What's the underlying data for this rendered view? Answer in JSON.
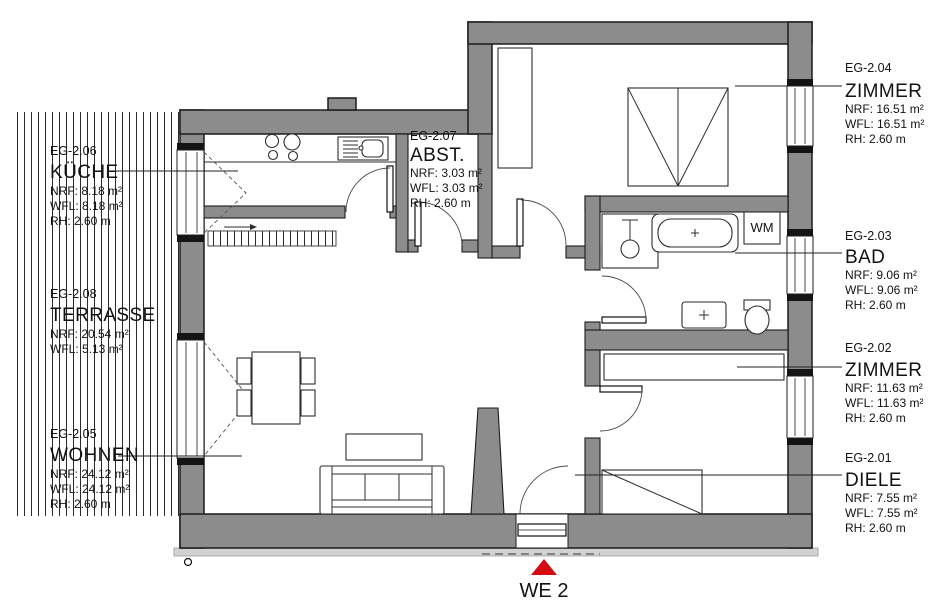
{
  "plan": {
    "unit": "WE 2",
    "labels": {
      "wm": "WM"
    },
    "rooms": [
      {
        "key": "kueche",
        "code": "EG-2.06",
        "name": "KÜCHE",
        "nrf": "NRF: 8.18 m²",
        "wfl": "WFL: 8.18 m²",
        "rh": "RH: 2.60 m"
      },
      {
        "key": "terrasse",
        "code": "EG-2.08",
        "name": "TERRASSE",
        "nrf": "NRF: 20.54 m²",
        "wfl": "WFL: 5.13 m²",
        "rh": ""
      },
      {
        "key": "wohnen",
        "code": "EG-2.05",
        "name": "WOHNEN",
        "nrf": "NRF: 24.12 m²",
        "wfl": "WFL: 24.12 m²",
        "rh": "RH: 2.60 m"
      },
      {
        "key": "abstellraum",
        "code": "EG-2.07",
        "name": "ABST.",
        "nrf": "NRF: 3.03 m²",
        "wfl": "WFL: 3.03 m²",
        "rh": "RH: 2.60 m"
      },
      {
        "key": "zimmer-204",
        "code": "EG-2.04",
        "name": "ZIMMER",
        "nrf": "NRF: 16.51 m²",
        "wfl": "WFL: 16.51 m²",
        "rh": "RH: 2.60 m"
      },
      {
        "key": "bad",
        "code": "EG-2.03",
        "name": "BAD",
        "nrf": "NRF: 9.06 m²",
        "wfl": "WFL: 9.06 m²",
        "rh": "RH: 2.60 m"
      },
      {
        "key": "zimmer-202",
        "code": "EG-2.02",
        "name": "ZIMMER",
        "nrf": "NRF: 11.63 m²",
        "wfl": "WFL: 11.63 m²",
        "rh": "RH: 2.60 m"
      },
      {
        "key": "diele",
        "code": "EG-2.01",
        "name": "DIELE",
        "nrf": "NRF: 7.55 m²",
        "wfl": "WFL: 7.55 m²",
        "rh": "RH: 2.60 m"
      }
    ],
    "colors": {
      "wall": "#8c8c8c",
      "outline": "#1c1c1c",
      "marker": "#d40b12",
      "footing": "#d2d2d2"
    }
  }
}
